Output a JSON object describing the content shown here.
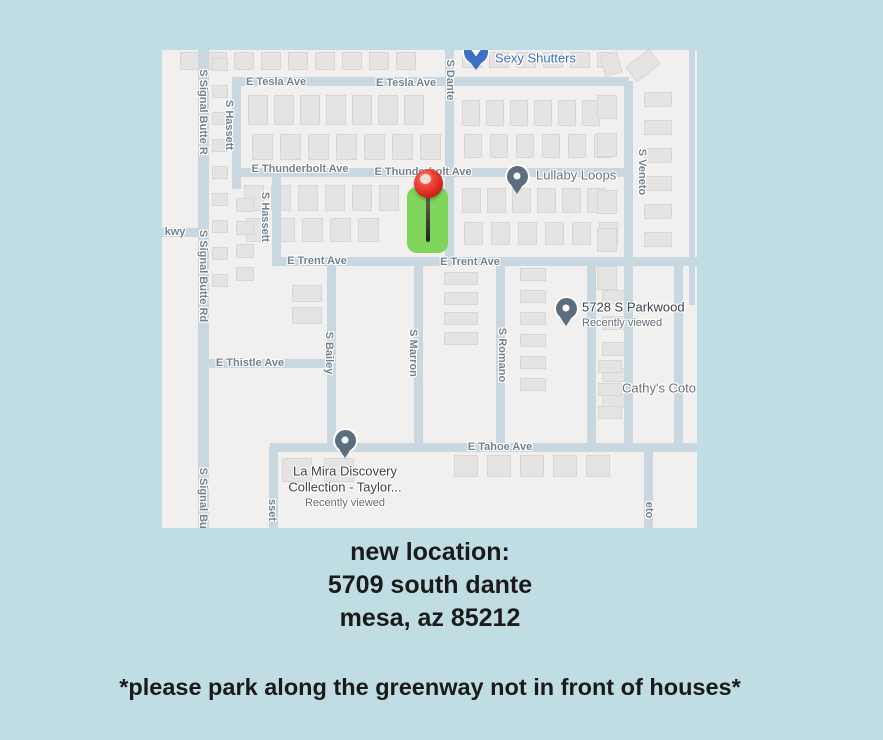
{
  "colors": {
    "page_bg": "#bfdde3",
    "map_bg": "#f1f0ee",
    "road": "#c9d7e1",
    "house": "#e5e4e3",
    "house_border": "#d8d7d6",
    "street_label": "#74828e",
    "poi_gray": "#6a737b",
    "poi_dark": "#3c434b",
    "poi_sub": "#666d74",
    "business_blue": "#3d6fc4",
    "pin_slate": "#5c6e7d",
    "parcel_green": "#7fd55a",
    "caption_text": "#1a1a1a"
  },
  "map": {
    "roads": [
      {
        "x": 36,
        "y": 0,
        "w": 11,
        "h": 478
      },
      {
        "x": 0,
        "y": 178,
        "w": 37,
        "h": 9
      },
      {
        "x": 70,
        "y": 27,
        "w": 397,
        "h": 9
      },
      {
        "x": 70,
        "y": 27,
        "w": 9,
        "h": 100
      },
      {
        "x": 70,
        "y": 118,
        "w": 401,
        "h": 9
      },
      {
        "x": 110,
        "y": 122,
        "w": 9,
        "h": 94
      },
      {
        "x": 70,
        "y": 127,
        "w": 9,
        "h": 12
      },
      {
        "x": 283,
        "y": 0,
        "w": 9,
        "h": 216
      },
      {
        "x": 110,
        "y": 207,
        "w": 425,
        "h": 9
      },
      {
        "x": 165,
        "y": 216,
        "w": 9,
        "h": 186
      },
      {
        "x": 252,
        "y": 216,
        "w": 9,
        "h": 186
      },
      {
        "x": 334,
        "y": 216,
        "w": 9,
        "h": 186
      },
      {
        "x": 41,
        "y": 309,
        "w": 133,
        "h": 9
      },
      {
        "x": 108,
        "y": 393,
        "w": 427,
        "h": 9
      },
      {
        "x": 107,
        "y": 397,
        "w": 9,
        "h": 81
      },
      {
        "x": 462,
        "y": 31,
        "w": 9,
        "h": 366
      },
      {
        "x": 482,
        "y": 397,
        "w": 9,
        "h": 81
      },
      {
        "x": 425,
        "y": 216,
        "w": 9,
        "h": 181
      },
      {
        "x": 512,
        "y": 216,
        "w": 9,
        "h": 181
      },
      {
        "x": 527,
        "y": 0,
        "w": 6,
        "h": 255
      }
    ],
    "houses": [
      {
        "x": 18,
        "y": 2,
        "w": 20,
        "h": 18,
        "n": 9,
        "gap": 7
      },
      {
        "x": 300,
        "y": 2,
        "w": 20,
        "h": 16,
        "n": 6,
        "gap": 7
      },
      {
        "x": 86,
        "y": 45,
        "w": 20,
        "h": 30,
        "n": 7,
        "gap": 6
      },
      {
        "x": 90,
        "y": 84,
        "w": 21,
        "h": 26,
        "n": 7,
        "gap": 7
      },
      {
        "x": 300,
        "y": 50,
        "w": 18,
        "h": 26,
        "n": 6,
        "gap": 6
      },
      {
        "x": 302,
        "y": 84,
        "w": 18,
        "h": 24,
        "n": 6,
        "gap": 8
      },
      {
        "x": 82,
        "y": 135,
        "w": 20,
        "h": 26,
        "n": 6,
        "gap": 7
      },
      {
        "x": 84,
        "y": 168,
        "w": 21,
        "h": 24,
        "n": 5,
        "gap": 7
      },
      {
        "x": 300,
        "y": 138,
        "w": 19,
        "h": 25,
        "n": 6,
        "gap": 6
      },
      {
        "x": 302,
        "y": 172,
        "w": 19,
        "h": 23,
        "n": 6,
        "gap": 8
      },
      {
        "x": 50,
        "y": 8,
        "w": 16,
        "h": 13,
        "n": 9,
        "gap": 14,
        "v": 1
      },
      {
        "x": 74,
        "y": 148,
        "w": 18,
        "h": 14,
        "n": 4,
        "gap": 9,
        "v": 1
      },
      {
        "x": 130,
        "y": 235,
        "w": 30,
        "h": 17,
        "n": 2,
        "gap": 5,
        "v": 1
      },
      {
        "x": 282,
        "y": 222,
        "w": 34,
        "h": 13,
        "n": 4,
        "gap": 7,
        "v": 1
      },
      {
        "x": 358,
        "y": 218,
        "w": 26,
        "h": 13,
        "n": 6,
        "gap": 9,
        "v": 1
      },
      {
        "x": 440,
        "y": 240,
        "w": 26,
        "h": 14,
        "n": 5,
        "gap": 12,
        "v": 1
      },
      {
        "x": 436,
        "y": 310,
        "w": 24,
        "h": 13,
        "n": 3,
        "gap": 10,
        "v": 1
      },
      {
        "x": 435,
        "y": 45,
        "w": 20,
        "h": 24,
        "n": 2,
        "gap": 14,
        "v": 1
      },
      {
        "x": 435,
        "y": 140,
        "w": 20,
        "h": 24,
        "n": 3,
        "gap": 14,
        "v": 1
      },
      {
        "x": 482,
        "y": 42,
        "w": 28,
        "h": 15,
        "n": 6,
        "gap": 13,
        "v": 1
      },
      {
        "x": 292,
        "y": 405,
        "w": 24,
        "h": 22,
        "n": 5,
        "gap": 9
      },
      {
        "x": 120,
        "y": 408,
        "w": 30,
        "h": 24,
        "n": 2,
        "gap": 12
      },
      {
        "x": 466,
        "y": 6,
        "w": 30,
        "h": 19,
        "n": 1,
        "gap": 0,
        "rot": -38
      },
      {
        "x": 440,
        "y": 3,
        "w": 18,
        "h": 22,
        "n": 1,
        "gap": 0,
        "rot": -15
      }
    ],
    "street_labels": [
      {
        "t": "E Tesla Ave",
        "x": 114,
        "y": 32
      },
      {
        "t": "E Tesla Ave",
        "x": 244,
        "y": 33
      },
      {
        "t": "S Dante",
        "x": 288,
        "y": 30,
        "r": 90
      },
      {
        "t": "S Signal Butte R",
        "x": 41,
        "y": 62,
        "r": 90
      },
      {
        "t": "S Signal Butte Rd",
        "x": 41,
        "y": 226,
        "r": 90
      },
      {
        "t": "S Signal But",
        "x": 41,
        "y": 450,
        "r": 90
      },
      {
        "t": "S Hassett",
        "x": 67,
        "y": 75,
        "r": 90
      },
      {
        "t": "S Hassett",
        "x": 103,
        "y": 167,
        "r": 90
      },
      {
        "t": "E Thunderbolt Ave",
        "x": 138,
        "y": 119
      },
      {
        "t": "E Thunderbolt Ave",
        "x": 261,
        "y": 122
      },
      {
        "t": "S Veneto",
        "x": 480,
        "y": 122,
        "r": 90
      },
      {
        "t": "kwy",
        "x": 13,
        "y": 182
      },
      {
        "t": "E Trent Ave",
        "x": 155,
        "y": 211
      },
      {
        "t": "E Trent Ave",
        "x": 308,
        "y": 212
      },
      {
        "t": "S Bailey",
        "x": 167,
        "y": 303,
        "r": 90
      },
      {
        "t": "S Marron",
        "x": 251,
        "y": 303,
        "r": 90
      },
      {
        "t": "S Romano",
        "x": 340,
        "y": 305,
        "r": 90
      },
      {
        "t": "E Thistle Ave",
        "x": 88,
        "y": 313
      },
      {
        "t": "E Tahoe Ave",
        "x": 338,
        "y": 397
      },
      {
        "t": "sset",
        "x": 110,
        "y": 460,
        "r": 90
      },
      {
        "t": "eto",
        "x": 487,
        "y": 460,
        "r": 90
      }
    ],
    "pois": [
      {
        "kind": "business",
        "name": "sexy-shutters",
        "icon": {
          "x": 314,
          "y": 2
        },
        "label": "Sexy Shutters",
        "lx": 333,
        "ly": 8
      },
      {
        "kind": "pin-label",
        "name": "lullaby-loops",
        "icon": {
          "x": 355,
          "y": 126
        },
        "label": "Lullaby Loops",
        "lx": 374,
        "ly": 125
      },
      {
        "kind": "pin-title",
        "name": "parkwood-saved-place",
        "icon": {
          "x": 404,
          "y": 258
        },
        "title": "5728 S Parkwood",
        "sub": "Recently viewed",
        "lx": 420,
        "ty": 257,
        "sy": 273
      },
      {
        "kind": "text",
        "name": "cathys-label",
        "label": "Cathy's Cotor",
        "lx": 460,
        "ly": 338
      },
      {
        "kind": "pin-center",
        "name": "la-mira-saved-place",
        "icon": {
          "x": 183,
          "y": 390
        },
        "cx": 183,
        "lines": [
          "La Mira Discovery",
          "Collection -  Taylor...",
          "Recently viewed"
        ],
        "lys": [
          421,
          437,
          453
        ]
      }
    ],
    "parcel": {
      "x": 245,
      "y": 137,
      "w": 41,
      "h": 66
    },
    "pin": {
      "ball": {
        "x": 252,
        "y": 119,
        "d": 29
      },
      "highlight": {
        "x": 258,
        "y": 124
      },
      "needle": {
        "x": 264,
        "y": 140,
        "h": 52
      }
    }
  },
  "caption": {
    "lines": [
      "new location:",
      "5709 south dante",
      "mesa, az 85212"
    ],
    "note": "*please park along the greenway not in front of houses*"
  }
}
